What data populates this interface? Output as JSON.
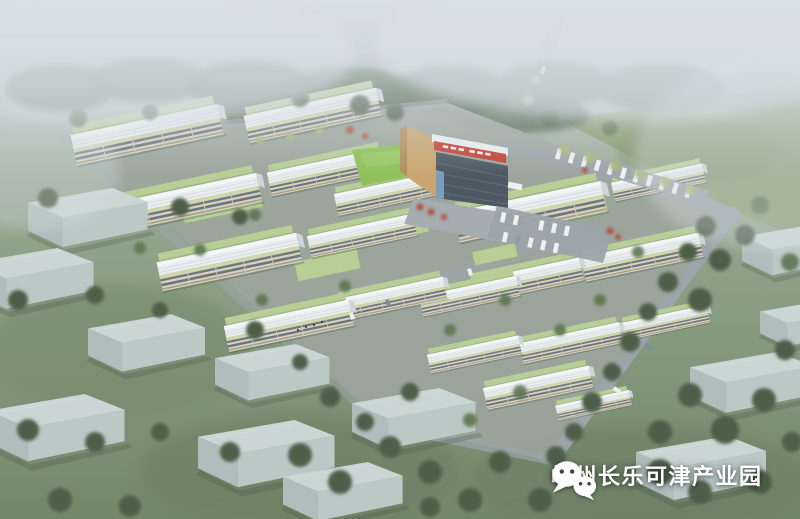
{
  "watermark": {
    "icon": "wechat-icon",
    "label": "嵊州长乐可津产业园"
  },
  "colors": {
    "sky_top": "#b6bfc2",
    "grass_mid": "#8da186",
    "grass_deep": "#6e8264",
    "field": "#87996e",
    "tree_dark": "#46593f",
    "tree_mid": "#567049",
    "tree_accent": "#a9b472",
    "tree_red": "#b04a30",
    "road": "#99a2a7",
    "park_ground": "#9aa29a",
    "factory_roof": "#eceff1",
    "factory_facade": "#dcd4bc",
    "green_roof": "#b6ce93",
    "context_top": "#c9d6d3",
    "context_left": "#aebdbb",
    "context_right": "#b9c8c5",
    "admin_glass": "#46525c",
    "admin_wall": "#c9a36b",
    "admin_sign": "#c2392b",
    "lawn": "#8cbf52",
    "vehicle": "#f0f3f4",
    "fog": "#dae2e7",
    "watermark_text": "#ffffff"
  }
}
